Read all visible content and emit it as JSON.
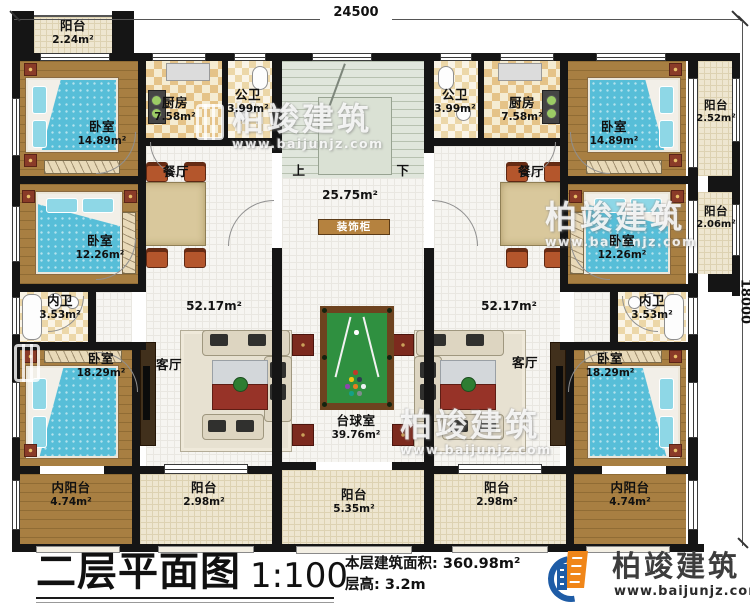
{
  "dimensions": {
    "width": "24500",
    "height": "18000"
  },
  "title": {
    "name": "二层平面图",
    "scale": "1:100",
    "floor_area_label": "本层建筑面积:",
    "floor_area_value": "360.98m²",
    "floor_height_label": "层高:",
    "floor_height_value": "3.2m"
  },
  "brand": {
    "name": "柏竣建筑",
    "website": "www.baijunjz.com"
  },
  "left_unit": {
    "balcony_top": {
      "name": "阳台",
      "area": "2.24m²"
    },
    "bedroom1": {
      "name": "卧室",
      "area": "14.89m²"
    },
    "kitchen": {
      "name": "厨房",
      "area": "7.58m²"
    },
    "public_bath": {
      "name": "公卫",
      "area": "3.99m²"
    },
    "dining": {
      "name": "餐厅"
    },
    "bedroom2": {
      "name": "卧室",
      "area": "12.26m²"
    },
    "ensuite_bath": {
      "name": "内卫",
      "area": "3.53m²"
    },
    "bedroom3": {
      "name": "卧室",
      "area": "18.29m²"
    },
    "living": {
      "name": "客厅"
    },
    "unit_area": "52.17m²",
    "inner_balcony": {
      "name": "内阳台",
      "area": "4.74m²"
    },
    "balcony_bottom": {
      "name": "阳台",
      "area": "2.98m²"
    }
  },
  "right_unit": {
    "public_bath": {
      "name": "公卫",
      "area": "3.99m²"
    },
    "kitchen": {
      "name": "厨房",
      "area": "7.58m²"
    },
    "bedroom1": {
      "name": "卧室",
      "area": "14.89m²"
    },
    "balcony_side1": {
      "name": "阳台",
      "area": "2.52m²"
    },
    "dining": {
      "name": "餐厅"
    },
    "bedroom2": {
      "name": "卧室",
      "area": "12.26m²"
    },
    "balcony_side2": {
      "name": "阳台",
      "area": "2.06m²"
    },
    "ensuite_bath": {
      "name": "内卫",
      "area": "3.53m²"
    },
    "bedroom3": {
      "name": "卧室",
      "area": "18.29m²"
    },
    "living": {
      "name": "客厅"
    },
    "unit_area": "52.17m²",
    "inner_balcony": {
      "name": "内阳台",
      "area": "4.74m²"
    },
    "balcony_bottom": {
      "name": "阳台",
      "area": "2.98m²"
    }
  },
  "center": {
    "stair_up": "上",
    "stair_down": "下",
    "stair_area": "25.75m²",
    "cabinet": "装饰柜",
    "billiard": {
      "name": "台球室",
      "area": "39.76m²"
    },
    "balcony_bottom": {
      "name": "阳台",
      "area": "5.35m²"
    }
  }
}
